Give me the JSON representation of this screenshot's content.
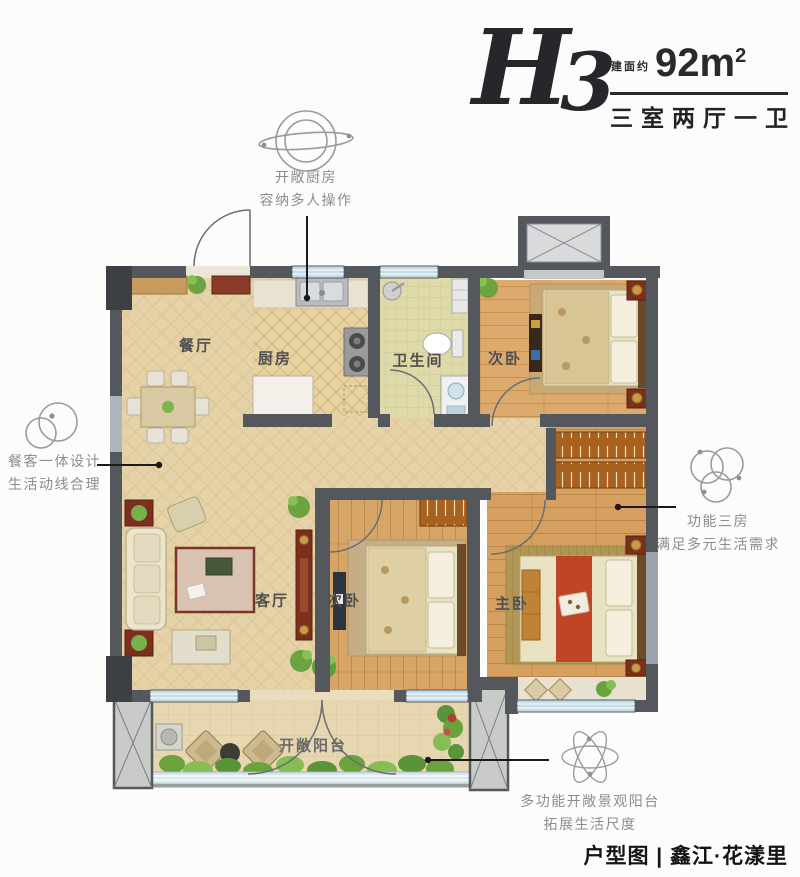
{
  "header": {
    "plan_code_letter": "H",
    "plan_code_number": "3",
    "area_prefix": "建面约",
    "area_value": "92m",
    "area_sup": "2",
    "layout_type": "三室两厅一卫"
  },
  "annotations": {
    "kitchen": {
      "icon": "orbit-circles-icon",
      "line1": "开敞厨房",
      "line2": "容纳多人操作"
    },
    "dining": {
      "icon": "two-circles-icon",
      "line1": "餐客一体设计",
      "line2": "生活动线合理"
    },
    "rooms": {
      "icon": "three-circles-icon",
      "line1": "功能三房",
      "line2": "满足多元生活需求"
    },
    "balcony": {
      "icon": "atom-ellipses-icon",
      "line1": "多功能开敞景观阳台",
      "line2": "拓展生活尺度"
    }
  },
  "rooms": {
    "dining": "餐厅",
    "kitchen": "厨房",
    "bathroom": "卫生间",
    "bedroom_top": "次卧",
    "living": "客厅",
    "bedroom_bottom": "次卧",
    "master": "主卧",
    "balcony": "开敞阳台"
  },
  "footer": {
    "caption": "户型图 | 鑫江·花漾里"
  },
  "colors": {
    "wall": "#54575c",
    "wall_dark": "#3c3f44",
    "window_blue": "#c4dde7",
    "tile_beige": "#e5d2a6",
    "wood": "#d9a86a",
    "bath_floor": "#dfdaa9",
    "wardrobe": "#a8611f",
    "accent_furniture": "#7c2f1d",
    "bed_runner_red": "#bf4526",
    "annotation_gray": "#8d8d8d",
    "ink": "#26262b"
  }
}
